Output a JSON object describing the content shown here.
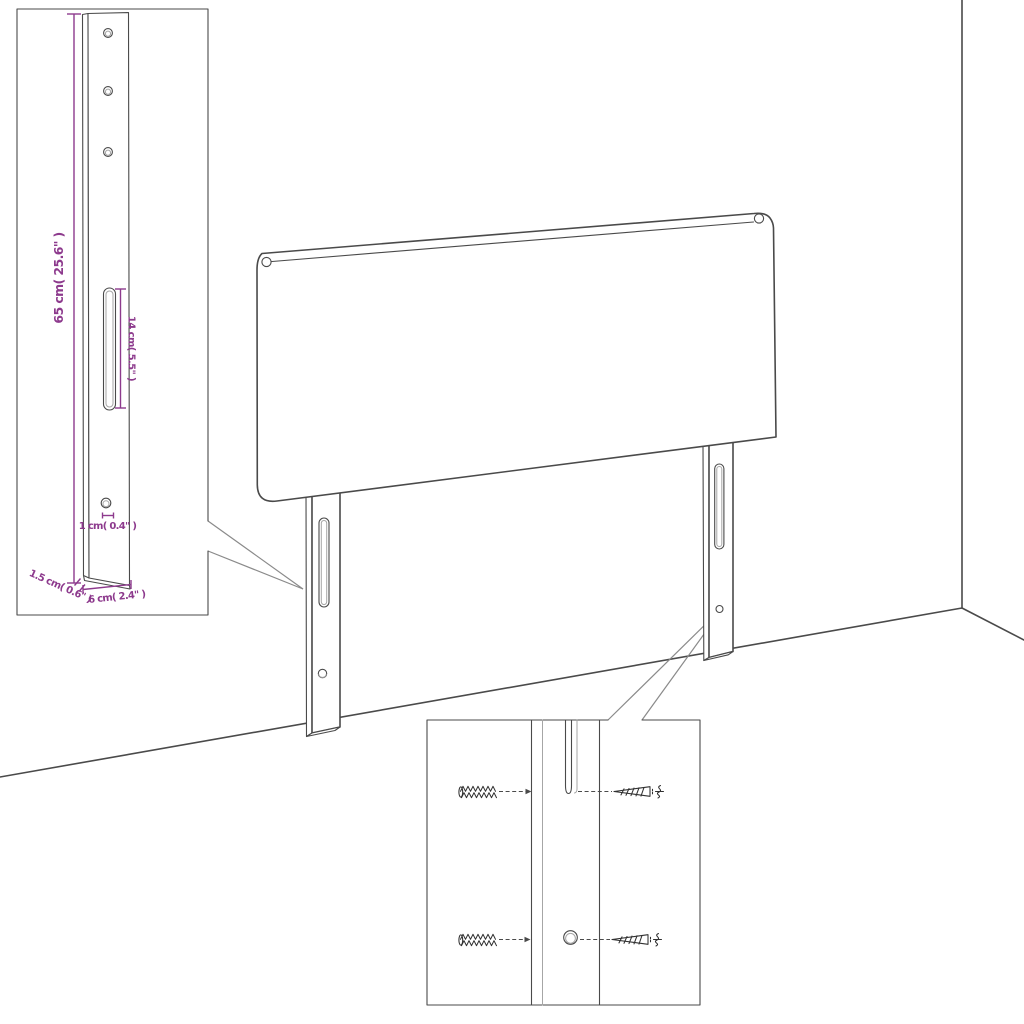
{
  "colors": {
    "background": "#ffffff",
    "outline": "#4a4a4a",
    "detail": "#a6a6a6",
    "screw": "#303030",
    "accent": "#8d3a8d"
  },
  "labels": {
    "leg_height": "65 cm( 25.6\" )",
    "slot_length": "14 cm( 5.5\" )",
    "hole_diameter": "1 cm( 0.4\" )",
    "leg_thickness": "1.5 cm( 0.6\" )",
    "leg_width": "6 cm( 2.4\" )"
  }
}
